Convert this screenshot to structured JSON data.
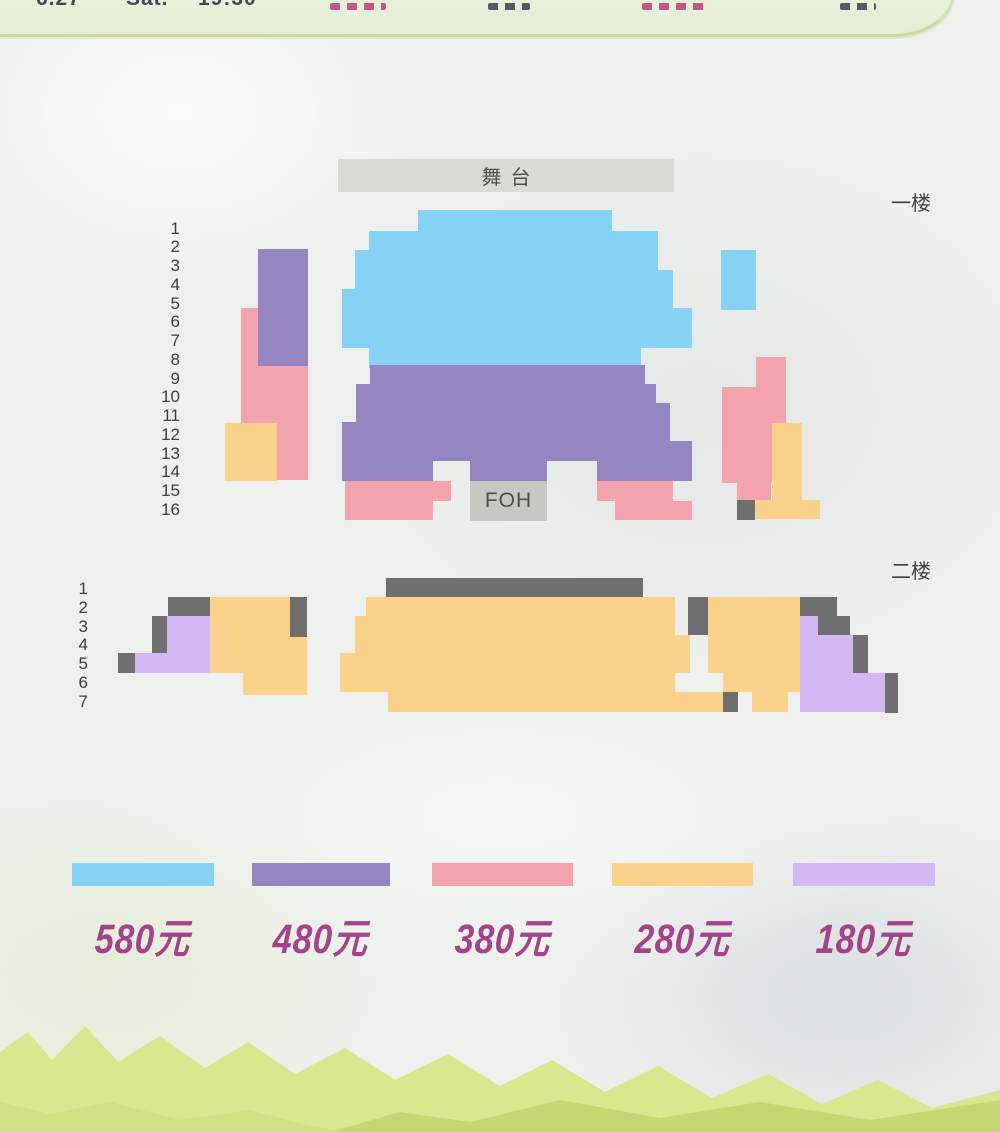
{
  "header": {
    "fragments": [
      {
        "kind": "text",
        "text": "6.27",
        "tone": "dark",
        "x": 36,
        "w": 54
      },
      {
        "kind": "text",
        "text": "Sat.",
        "tone": "dark",
        "x": 126,
        "w": 48
      },
      {
        "kind": "text",
        "text": "19:30",
        "tone": "dark",
        "x": 198,
        "w": 66
      },
      {
        "kind": "marks",
        "text": "",
        "tone": "pink",
        "x": 330,
        "w": 56
      },
      {
        "kind": "marks",
        "text": "",
        "tone": "dark",
        "x": 488,
        "w": 42
      },
      {
        "kind": "marks",
        "text": "",
        "tone": "pink",
        "x": 642,
        "w": 66
      },
      {
        "kind": "marks",
        "text": "",
        "tone": "dark",
        "x": 840,
        "w": 36
      }
    ],
    "tones": {
      "dark": "#44475a",
      "pink": "#c2437e"
    }
  },
  "palette": {
    "blue": "#85d2f4",
    "purple": "#9484bf",
    "pink": "#f2a3ab",
    "orange": "#fbd28c",
    "lavender": "#d3b8f3",
    "dark": "#6f6f6f"
  },
  "stage": {
    "label": "舞台"
  },
  "foh": {
    "label": "FOH"
  },
  "floors": {
    "floor1": {
      "label": "一楼",
      "rows": [
        1,
        2,
        3,
        4,
        5,
        6,
        7,
        8,
        9,
        10,
        11,
        12,
        13,
        14,
        15,
        16
      ],
      "blocks": [
        {
          "x": 241,
          "y": 308,
          "w": 67,
          "h": 172,
          "c": "pink"
        },
        {
          "x": 258,
          "y": 249,
          "w": 50,
          "h": 117,
          "c": "purple"
        },
        {
          "x": 225,
          "y": 423,
          "w": 52,
          "h": 58,
          "c": "orange"
        },
        {
          "x": 418,
          "y": 210,
          "w": 194,
          "h": 21,
          "c": "blue"
        },
        {
          "x": 369,
          "y": 231,
          "w": 289,
          "h": 19,
          "c": "blue"
        },
        {
          "x": 355,
          "y": 250,
          "w": 303,
          "h": 20,
          "c": "blue"
        },
        {
          "x": 355,
          "y": 270,
          "w": 318,
          "h": 19,
          "c": "blue"
        },
        {
          "x": 342,
          "y": 289,
          "w": 331,
          "h": 19,
          "c": "blue"
        },
        {
          "x": 342,
          "y": 308,
          "w": 350,
          "h": 40,
          "c": "blue"
        },
        {
          "x": 369,
          "y": 348,
          "w": 272,
          "h": 20,
          "c": "blue"
        },
        {
          "x": 721,
          "y": 250,
          "w": 35,
          "h": 60,
          "c": "blue"
        },
        {
          "x": 370,
          "y": 365,
          "w": 275,
          "h": 19,
          "c": "purple"
        },
        {
          "x": 356,
          "y": 384,
          "w": 300,
          "h": 19,
          "c": "purple"
        },
        {
          "x": 356,
          "y": 403,
          "w": 314,
          "h": 19,
          "c": "purple"
        },
        {
          "x": 342,
          "y": 422,
          "w": 328,
          "h": 19,
          "c": "purple"
        },
        {
          "x": 342,
          "y": 441,
          "w": 350,
          "h": 20,
          "c": "purple"
        },
        {
          "x": 342,
          "y": 461,
          "w": 91,
          "h": 20,
          "c": "purple"
        },
        {
          "x": 470,
          "y": 461,
          "w": 77,
          "h": 20,
          "c": "purple"
        },
        {
          "x": 597,
          "y": 461,
          "w": 95,
          "h": 20,
          "c": "purple"
        },
        {
          "x": 345,
          "y": 481,
          "w": 106,
          "h": 20,
          "c": "pink"
        },
        {
          "x": 345,
          "y": 501,
          "w": 88,
          "h": 19,
          "c": "pink"
        },
        {
          "x": 597,
          "y": 481,
          "w": 76,
          "h": 20,
          "c": "pink"
        },
        {
          "x": 615,
          "y": 501,
          "w": 77,
          "h": 19,
          "c": "pink"
        },
        {
          "x": 722,
          "y": 387,
          "w": 64,
          "h": 96,
          "c": "pink"
        },
        {
          "x": 756,
          "y": 357,
          "w": 30,
          "h": 30,
          "c": "pink"
        },
        {
          "x": 772,
          "y": 423,
          "w": 30,
          "h": 77,
          "c": "orange"
        },
        {
          "x": 737,
          "y": 483,
          "w": 34,
          "h": 17,
          "c": "pink"
        },
        {
          "x": 737,
          "y": 500,
          "w": 18,
          "h": 20,
          "c": "dark"
        },
        {
          "x": 755,
          "y": 500,
          "w": 65,
          "h": 19,
          "c": "orange"
        }
      ]
    },
    "floor2": {
      "label": "二楼",
      "rows": [
        1,
        2,
        3,
        4,
        5,
        6,
        7
      ],
      "blocks": [
        {
          "x": 386,
          "y": 578,
          "w": 257,
          "h": 19,
          "c": "dark"
        },
        {
          "x": 366,
          "y": 597,
          "w": 309,
          "h": 19,
          "c": "orange"
        },
        {
          "x": 355,
          "y": 616,
          "w": 320,
          "h": 19,
          "c": "orange"
        },
        {
          "x": 355,
          "y": 635,
          "w": 335,
          "h": 18,
          "c": "orange"
        },
        {
          "x": 340,
          "y": 653,
          "w": 350,
          "h": 20,
          "c": "orange"
        },
        {
          "x": 340,
          "y": 673,
          "w": 335,
          "h": 19,
          "c": "orange"
        },
        {
          "x": 388,
          "y": 692,
          "w": 335,
          "h": 20,
          "c": "orange"
        },
        {
          "x": 723,
          "y": 691,
          "w": 15,
          "h": 21,
          "c": "dark"
        },
        {
          "x": 168,
          "y": 597,
          "w": 42,
          "h": 19,
          "c": "dark"
        },
        {
          "x": 290,
          "y": 597,
          "w": 17,
          "h": 40,
          "c": "dark"
        },
        {
          "x": 152,
          "y": 616,
          "w": 15,
          "h": 37,
          "c": "dark"
        },
        {
          "x": 118,
          "y": 653,
          "w": 17,
          "h": 20,
          "c": "dark"
        },
        {
          "x": 167,
          "y": 616,
          "w": 43,
          "h": 37,
          "c": "lavender"
        },
        {
          "x": 135,
          "y": 653,
          "w": 75,
          "h": 20,
          "c": "lavender"
        },
        {
          "x": 210,
          "y": 597,
          "w": 80,
          "h": 40,
          "c": "orange"
        },
        {
          "x": 210,
          "y": 637,
          "w": 97,
          "h": 36,
          "c": "orange"
        },
        {
          "x": 243,
          "y": 673,
          "w": 64,
          "h": 22,
          "c": "orange"
        },
        {
          "x": 688,
          "y": 597,
          "w": 20,
          "h": 38,
          "c": "dark"
        },
        {
          "x": 800,
          "y": 597,
          "w": 37,
          "h": 19,
          "c": "dark"
        },
        {
          "x": 818,
          "y": 616,
          "w": 32,
          "h": 19,
          "c": "dark"
        },
        {
          "x": 853,
          "y": 635,
          "w": 15,
          "h": 38,
          "c": "dark"
        },
        {
          "x": 885,
          "y": 673,
          "w": 13,
          "h": 40,
          "c": "dark"
        },
        {
          "x": 708,
          "y": 597,
          "w": 92,
          "h": 76,
          "c": "orange"
        },
        {
          "x": 723,
          "y": 673,
          "w": 77,
          "h": 19,
          "c": "orange"
        },
        {
          "x": 752,
          "y": 692,
          "w": 36,
          "h": 20,
          "c": "orange"
        },
        {
          "x": 800,
          "y": 616,
          "w": 18,
          "h": 19,
          "c": "lavender"
        },
        {
          "x": 800,
          "y": 635,
          "w": 53,
          "h": 38,
          "c": "lavender"
        },
        {
          "x": 800,
          "y": 673,
          "w": 85,
          "h": 19,
          "c": "lavender"
        },
        {
          "x": 800,
          "y": 692,
          "w": 85,
          "h": 20,
          "c": "lavender"
        }
      ]
    }
  },
  "legend": {
    "price_color": "#a5438a",
    "items": [
      {
        "price": "580元",
        "color": "#85d2f4",
        "x": 72,
        "w": 142
      },
      {
        "price": "480元",
        "color": "#9484bf",
        "x": 252,
        "w": 138
      },
      {
        "price": "380元",
        "color": "#f2a3ab",
        "x": 432,
        "w": 141
      },
      {
        "price": "280元",
        "color": "#fbd28c",
        "x": 612,
        "w": 141
      },
      {
        "price": "180元",
        "color": "#d3b8f3",
        "x": 793,
        "w": 142
      }
    ]
  }
}
